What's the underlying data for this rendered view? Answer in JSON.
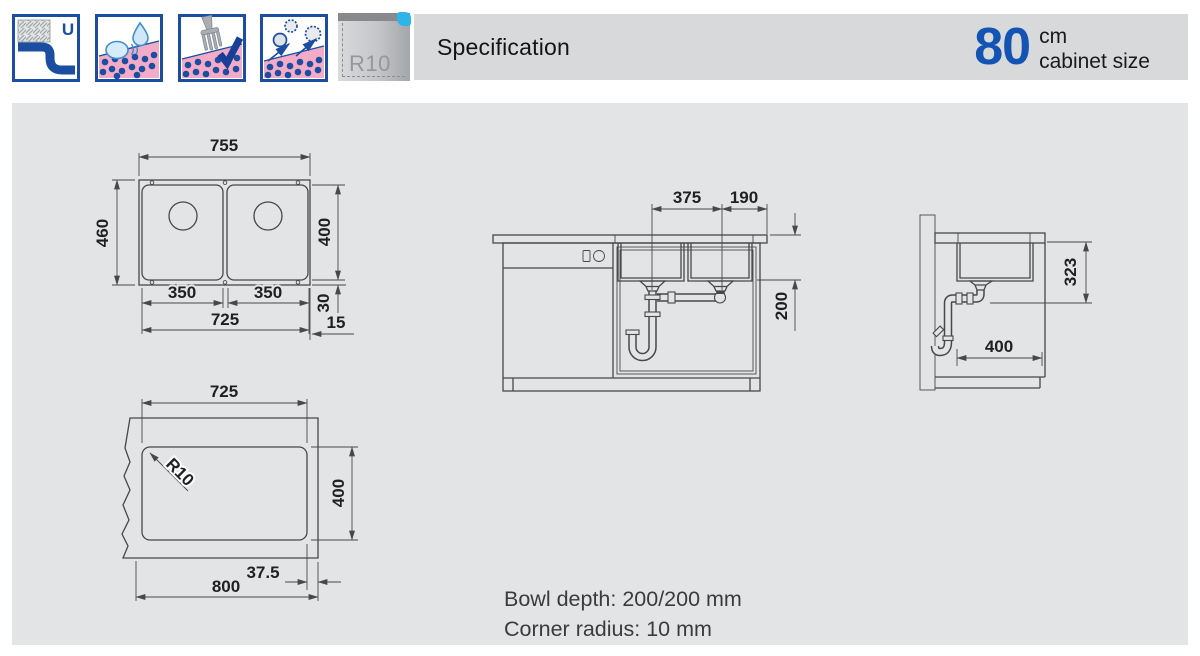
{
  "header": {
    "title": "Specification",
    "icons": [
      {
        "id": "undermount",
        "letter": "U"
      },
      {
        "id": "pearl-effect"
      },
      {
        "id": "cutlery-scratch-resistant"
      },
      {
        "id": "dirt-repellent"
      }
    ],
    "badge": {
      "label": "R10"
    },
    "cabinet": {
      "size": "80",
      "unit": "cm",
      "caption": "cabinet size"
    }
  },
  "notes": {
    "bowl_depth": "Bowl depth: 200/200 mm",
    "corner_radius": "Corner radius: 10 mm"
  },
  "dims": {
    "top_view": {
      "overall_width": "755",
      "overall_depth": "460",
      "bowl_depth": "400",
      "bowl1_width": "350",
      "bowl2_width": "350",
      "bowls_span": "725",
      "rim_back": "30",
      "rim_side": "15"
    },
    "cutout_view": {
      "cutout_width": "725",
      "cutout_depth": "400",
      "corner_radius": "R10",
      "edge_offset": "37.5",
      "cabinet_width": "800"
    },
    "front_view": {
      "drain_spacing": "375",
      "drain_to_edge": "190",
      "bowl_depth": "200"
    },
    "side_view": {
      "clearance": "323",
      "bowl_front_back": "400"
    }
  },
  "colors": {
    "accent_blue": "#1253b4",
    "icon_blue": "#1b4da1",
    "panel_gray": "#e3e4e5",
    "bar_gray": "#d8d9da",
    "line": "#47484a",
    "pink": "#f3abc7",
    "cyan": "#2fb4e9"
  }
}
